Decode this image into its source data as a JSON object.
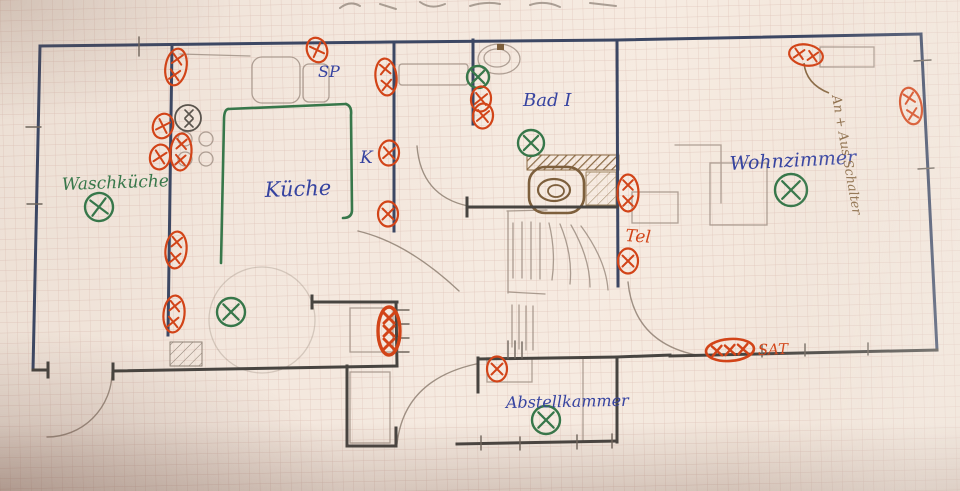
{
  "labels": {
    "waschkueche": "Waschküche",
    "kueche": "Küche",
    "bad": "Bad I",
    "wohnzimmer": "Wohnzimmer",
    "abstellkammer": "Abstellkammer",
    "sp": "SP",
    "k": "K",
    "tel": "Tel",
    "sat": "SAT",
    "schalter": "An + Aus Schalter"
  },
  "colors": {
    "paper": "#f3e7dd",
    "grid": "#c99f93",
    "wall_blue": "#3c4763",
    "wall_dark": "#474440",
    "blue_ink": "#3643a0",
    "green_ink": "#37774a",
    "red_ink": "#d24418",
    "brown_ink": "#8a6a45",
    "pencil": "#9d8d81"
  },
  "symbols": {
    "items": [
      {
        "type": "socket",
        "x": 317,
        "y": 50,
        "rot": -20
      },
      {
        "type": "socket2v",
        "x": 176,
        "y": 67,
        "rot": 10
      },
      {
        "type": "socket",
        "x": 163,
        "y": 126,
        "rot": 18
      },
      {
        "type": "socket2v",
        "x": 181,
        "y": 152,
        "rot": 4
      },
      {
        "type": "socket",
        "x": 160,
        "y": 157,
        "rot": 12
      },
      {
        "type": "pencil2",
        "x": 188,
        "y": 118,
        "rot": 0
      },
      {
        "type": "socket2v",
        "x": 386,
        "y": 77,
        "rot": -6
      },
      {
        "type": "socket",
        "x": 389,
        "y": 153,
        "rot": 4
      },
      {
        "type": "socket",
        "x": 388,
        "y": 214,
        "rot": 0
      },
      {
        "type": "light",
        "x": 478,
        "y": 77,
        "rot": 0,
        "r": 11
      },
      {
        "type": "socket",
        "x": 481,
        "y": 99,
        "rot": 6
      },
      {
        "type": "socket",
        "x": 483,
        "y": 116,
        "rot": 6
      },
      {
        "type": "light",
        "x": 531,
        "y": 143,
        "rot": 0,
        "r": 13
      },
      {
        "type": "socket2v",
        "x": 628,
        "y": 193,
        "rot": 0
      },
      {
        "type": "socket",
        "x": 628,
        "y": 261,
        "rot": 0
      },
      {
        "type": "socket2v",
        "x": 176,
        "y": 250,
        "rot": 6
      },
      {
        "type": "socket2v",
        "x": 174,
        "y": 314,
        "rot": 6
      },
      {
        "type": "light",
        "x": 99,
        "y": 207,
        "rot": -8,
        "r": 14
      },
      {
        "type": "light",
        "x": 231,
        "y": 312,
        "rot": 0,
        "r": 14
      },
      {
        "type": "socket3v",
        "x": 389,
        "y": 331,
        "rot": 0
      },
      {
        "type": "socket",
        "x": 497,
        "y": 369,
        "rot": 0
      },
      {
        "type": "light",
        "x": 546,
        "y": 420,
        "rot": 0,
        "r": 14
      },
      {
        "type": "socket3h",
        "x": 730,
        "y": 350,
        "rot": -4
      },
      {
        "type": "socket2h",
        "x": 806,
        "y": 55,
        "rot": 10
      },
      {
        "type": "socket2v",
        "x": 911,
        "y": 106,
        "rot": -12
      },
      {
        "type": "light",
        "x": 791,
        "y": 190,
        "rot": 0,
        "r": 16
      }
    ]
  }
}
